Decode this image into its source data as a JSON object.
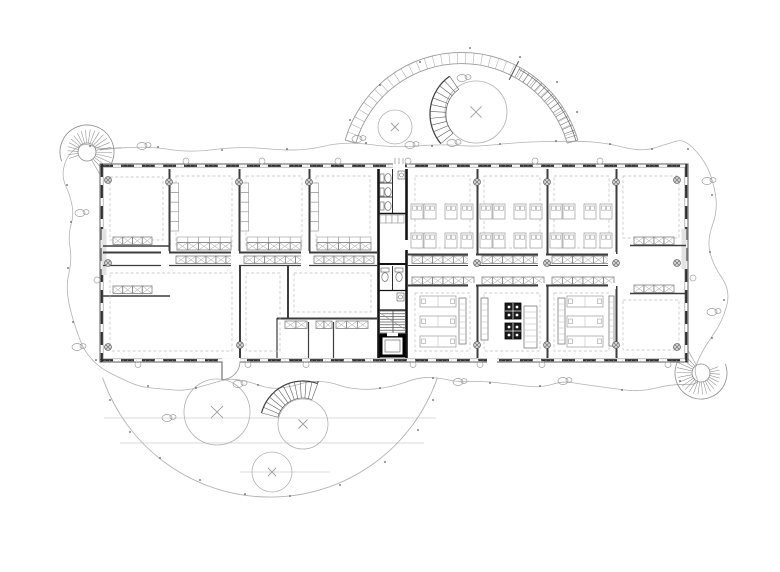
{
  "meta": {
    "drawing_type": "architectural-floor-plan",
    "canvas": {
      "width": 780,
      "height": 572,
      "background": "#ffffff"
    }
  },
  "palette": {
    "wall": "#3d3d3d",
    "core": "#141414",
    "furniture": "#8a8a8a",
    "furniture_light": "#ababab",
    "dashed": "#bfbfbf",
    "site": "#b3b3b3",
    "dark": "#2a2a2a",
    "mid": "#6e6e6e",
    "light_fill": "#e2e2e2",
    "equipment_fill": "#1a1a1a",
    "white": "#ffffff"
  },
  "scene": {
    "cloud_points": [
      [
        100,
        150
      ],
      [
        142,
        145
      ],
      [
        190,
        153
      ],
      [
        240,
        146
      ],
      [
        300,
        152
      ],
      [
        345,
        141
      ],
      [
        395,
        148
      ],
      [
        440,
        144
      ],
      [
        475,
        147
      ],
      [
        520,
        142
      ],
      [
        578,
        141
      ],
      [
        607,
        143
      ],
      [
        642,
        152
      ],
      [
        670,
        143
      ],
      [
        684,
        139
      ],
      [
        703,
        158
      ],
      [
        713,
        180
      ],
      [
        718,
        210
      ],
      [
        707,
        240
      ],
      [
        713,
        265
      ],
      [
        731,
        291
      ],
      [
        722,
        322
      ],
      [
        706,
        345
      ],
      [
        698,
        360
      ],
      [
        694,
        372
      ],
      [
        700,
        385
      ],
      [
        672,
        384
      ],
      [
        640,
        392
      ],
      [
        610,
        388
      ],
      [
        580,
        384
      ],
      [
        563,
        381
      ],
      [
        540,
        388
      ],
      [
        510,
        384
      ],
      [
        480,
        381
      ],
      [
        458,
        382
      ],
      [
        440,
        378
      ],
      [
        420,
        377
      ],
      [
        395,
        386
      ],
      [
        370,
        390
      ],
      [
        347,
        388
      ],
      [
        330,
        382
      ],
      [
        310,
        381
      ],
      [
        290,
        387
      ],
      [
        270,
        389
      ],
      [
        250,
        382
      ],
      [
        230,
        378
      ],
      [
        210,
        384
      ],
      [
        185,
        391
      ],
      [
        163,
        389
      ],
      [
        140,
        387
      ],
      [
        120,
        378
      ],
      [
        100,
        368
      ],
      [
        85,
        352
      ],
      [
        78,
        335
      ],
      [
        70,
        310
      ],
      [
        66,
        285
      ],
      [
        72,
        260
      ],
      [
        68,
        235
      ],
      [
        74,
        215
      ],
      [
        70,
        195
      ],
      [
        62,
        178
      ],
      [
        65,
        160
      ],
      [
        75,
        148
      ],
      [
        87,
        143
      ]
    ],
    "shrubs": [
      [
        142,
        146
      ],
      [
        410,
        145
      ],
      [
        563,
        381
      ],
      [
        458,
        382
      ],
      [
        707,
        181
      ],
      [
        712,
        312
      ],
      [
        80,
        213
      ],
      [
        77,
        347
      ],
      [
        238,
        384
      ],
      [
        167,
        418
      ],
      [
        462,
        78
      ],
      [
        452,
        143
      ],
      [
        357,
        139
      ]
    ],
    "dots": [
      [
        158,
        147
      ],
      [
        222,
        150
      ],
      [
        287,
        149
      ],
      [
        366,
        143
      ],
      [
        432,
        146
      ],
      [
        500,
        144
      ],
      [
        556,
        141
      ],
      [
        610,
        144
      ],
      [
        652,
        149
      ],
      [
        688,
        149
      ],
      [
        712,
        195
      ],
      [
        710,
        252
      ],
      [
        724,
        300
      ],
      [
        712,
        338
      ],
      [
        680,
        381
      ],
      [
        622,
        390
      ],
      [
        540,
        386
      ],
      [
        490,
        383
      ],
      [
        433,
        378
      ],
      [
        380,
        388
      ],
      [
        318,
        382
      ],
      [
        258,
        385
      ],
      [
        196,
        388
      ],
      [
        148,
        386
      ],
      [
        96,
        360
      ],
      [
        73,
        322
      ],
      [
        68,
        268
      ],
      [
        71,
        222
      ],
      [
        67,
        185
      ],
      [
        90,
        146
      ],
      [
        350,
        120
      ],
      [
        380,
        85
      ],
      [
        420,
        62
      ],
      [
        470,
        48
      ],
      [
        520,
        57
      ],
      [
        557,
        82
      ],
      [
        577,
        112
      ],
      [
        110,
        400
      ],
      [
        130,
        432
      ],
      [
        160,
        458
      ],
      [
        200,
        480
      ],
      [
        245,
        494
      ],
      [
        290,
        496
      ],
      [
        340,
        485
      ],
      [
        385,
        462
      ],
      [
        418,
        430
      ],
      [
        433,
        400
      ]
    ],
    "top_arc": {
      "cx": 461.5,
      "cy": 173.4,
      "r_out": 121,
      "r_in": 110,
      "a0": 196,
      "a1": 344,
      "tick_deg": 4,
      "ramp_a0": 299,
      "ramp_a1": 344,
      "section_a": 297
    },
    "bottom_arc": {
      "cx": 270,
      "cy": 320,
      "r": 177,
      "a0": 161,
      "a1": 19
    },
    "terrace_lines": [
      [
        104,
        418,
        436,
        418
      ],
      [
        120,
        443,
        424,
        443
      ],
      [
        240,
        472,
        330,
        472
      ]
    ],
    "trees": [
      [
        395,
        127,
        17
      ],
      [
        476,
        112,
        31
      ],
      [
        217,
        412,
        33
      ],
      [
        303,
        424,
        25
      ],
      [
        272,
        472,
        20
      ]
    ],
    "spirals": [
      {
        "cx": 87,
        "cy": 152,
        "r1": 9,
        "r2": 27,
        "a0": -200,
        "a1": 60,
        "n": 22
      },
      {
        "cx": 701,
        "cy": 373,
        "r1": 9,
        "r2": 26,
        "a0": -20,
        "a1": 240,
        "n": 22
      }
    ],
    "stair_fans": [
      {
        "cx": 476,
        "cy": 114,
        "r1": 30,
        "r2": 46,
        "a0": 140,
        "a1": 235,
        "n": 11
      },
      {
        "cx": 303,
        "cy": 424,
        "r1": 26,
        "r2": 43,
        "a0": 195,
        "a1": 290,
        "n": 12
      }
    ],
    "building": {
      "x": 100,
      "y": 164,
      "w": 588,
      "h": 198
    },
    "piers": [
      [
        101.5,
        229,
        5,
        46
      ],
      [
        681.5,
        229,
        5,
        40
      ]
    ],
    "walls": [
      [
        169.5,
        169,
        169.5,
        252,
        2
      ],
      [
        239.5,
        169,
        239.5,
        252,
        2
      ],
      [
        309.5,
        169,
        309.5,
        252,
        2
      ],
      [
        477.5,
        169,
        477.5,
        254,
        2
      ],
      [
        547.5,
        169,
        547.5,
        254,
        2
      ],
      [
        616.5,
        169,
        616.5,
        254,
        2
      ],
      [
        477.5,
        286,
        477.5,
        358,
        2
      ],
      [
        547.5,
        286,
        547.5,
        358,
        2
      ],
      [
        616.5,
        286,
        616.5,
        358,
        2
      ],
      [
        240,
        266,
        240,
        358,
        2
      ],
      [
        288,
        266,
        288,
        318,
        2
      ],
      [
        277,
        318,
        277,
        358,
        1.2
      ],
      [
        308.5,
        322,
        308.5,
        358,
        1.2
      ],
      [
        333.5,
        322,
        333.5,
        358,
        1.2
      ],
      [
        103,
        252.5,
        377,
        252.5,
        2
      ],
      [
        103,
        265.5,
        377,
        265.5,
        1.2
      ],
      [
        408,
        254.5,
        616,
        254.5,
        2
      ],
      [
        408,
        265.5,
        616,
        265.5,
        1
      ],
      [
        408,
        285.5,
        616,
        285.5,
        2
      ],
      [
        103,
        246,
        170,
        246,
        1.5
      ],
      [
        103,
        296,
        170,
        296,
        1.5
      ],
      [
        630,
        245.5,
        686,
        245.5,
        1.5
      ],
      [
        630,
        293.5,
        686,
        293.5,
        1.5
      ],
      [
        277,
        318.5,
        377,
        318.5,
        2
      ]
    ],
    "core_walls": [
      [
        378.5,
        169,
        378.5,
        358,
        2.6
      ],
      [
        406.5,
        169,
        406.5,
        358,
        2.6
      ],
      [
        379,
        213.5,
        406,
        213.5,
        1.5
      ],
      [
        379,
        264,
        406,
        264,
        2
      ],
      [
        379,
        290.5,
        406,
        290.5,
        1.2
      ],
      [
        379,
        310,
        406,
        310,
        1.2
      ],
      [
        379,
        334.5,
        406,
        334.5,
        2
      ],
      [
        392.5,
        169,
        392.5,
        213,
        0.9
      ],
      [
        392.5,
        266,
        392.5,
        290,
        0.9
      ],
      [
        379,
        183,
        392,
        183,
        0.8
      ],
      [
        379,
        197,
        392,
        197,
        0.8
      ]
    ],
    "dashed_rooms": [
      [
        110,
        177,
        53,
        63
      ],
      [
        176,
        176,
        56,
        70
      ],
      [
        246,
        176,
        56,
        70
      ],
      [
        316,
        176,
        54,
        70
      ],
      [
        415,
        176,
        55,
        72
      ],
      [
        484,
        176,
        56,
        72
      ],
      [
        554,
        176,
        55,
        72
      ],
      [
        623,
        176,
        56,
        62
      ],
      [
        110,
        273,
        122,
        78
      ],
      [
        246,
        273,
        34,
        78
      ],
      [
        294,
        273,
        77,
        39
      ],
      [
        415,
        293,
        55,
        58
      ],
      [
        484,
        293,
        56,
        58
      ],
      [
        554,
        293,
        55,
        58
      ],
      [
        623,
        300,
        56,
        50
      ]
    ],
    "locker_rows": [
      [
        176,
        256,
        60,
        6
      ],
      [
        244,
        256,
        62,
        6
      ],
      [
        314,
        256,
        60,
        6
      ],
      [
        412,
        256,
        62,
        6
      ],
      [
        482,
        256,
        62,
        6
      ],
      [
        552,
        256,
        62,
        6
      ],
      [
        412,
        277,
        62,
        6
      ],
      [
        482,
        277,
        62,
        6
      ],
      [
        552,
        277,
        62,
        6
      ],
      [
        285,
        321,
        22,
        2
      ],
      [
        316,
        321,
        16,
        2
      ],
      [
        336,
        321,
        32,
        3
      ],
      [
        634,
        237,
        40,
        4
      ],
      [
        634,
        285,
        40,
        4
      ],
      [
        113,
        237,
        39,
        4
      ],
      [
        113,
        286,
        39,
        4
      ]
    ],
    "bench_doubles": [
      [
        177,
        237,
        54,
        5
      ],
      [
        247,
        237,
        54,
        5
      ],
      [
        317,
        237,
        54,
        5
      ]
    ],
    "shelf_strips": [
      [
        170.5,
        183,
        8,
        48,
        5
      ],
      [
        240.5,
        183,
        8,
        48,
        5
      ],
      [
        310.5,
        183,
        8,
        48,
        5
      ]
    ],
    "desk_rooms": {
      "lefts": [
        408,
        477,
        547
      ],
      "cols": [
        3,
        16,
        37,
        53
      ],
      "rows": [
        204,
        233
      ],
      "size": [
        12,
        15
      ]
    },
    "tables": {
      "size": [
        36,
        11
      ],
      "items": [
        [
          420,
          296
        ],
        [
          420,
          316
        ],
        [
          420,
          336
        ],
        [
          567,
          296
        ],
        [
          567,
          316
        ],
        [
          567,
          336
        ]
      ]
    },
    "cabinets": [
      [
        459,
        298,
        7,
        46
      ],
      [
        481,
        298,
        7,
        42
      ],
      [
        524,
        306,
        13,
        42
      ],
      [
        558,
        298,
        7,
        46
      ],
      [
        609,
        296,
        5,
        50
      ]
    ],
    "equipment": {
      "size": 16,
      "items": [
        [
          505,
          303
        ],
        [
          505,
          323
        ]
      ]
    },
    "columns": [
      [
        169,
        182
      ],
      [
        239,
        182
      ],
      [
        309,
        182
      ],
      [
        477,
        182
      ],
      [
        547,
        182
      ],
      [
        616,
        182
      ],
      [
        477,
        263
      ],
      [
        547,
        263
      ],
      [
        616,
        263
      ],
      [
        477,
        345
      ],
      [
        547,
        345
      ],
      [
        616,
        345
      ],
      [
        240,
        345
      ],
      [
        108,
        180
      ],
      [
        108,
        263
      ],
      [
        108,
        347
      ],
      [
        677,
        180
      ],
      [
        677,
        263
      ],
      [
        677,
        347
      ]
    ],
    "markers": {
      "top_y": 161,
      "top_x": [
        186,
        262,
        338,
        408,
        535,
        600
      ],
      "bottom_y": 364.5,
      "bottom_x": [
        138,
        248,
        306,
        413,
        480,
        542,
        668
      ],
      "sides": [
        [
          97,
          280
        ],
        [
          693,
          278
        ]
      ]
    },
    "core_fixtures": {
      "toilets_right": [
        [
          380,
          172
        ],
        [
          380,
          186
        ],
        [
          380,
          200
        ]
      ],
      "toilets_down": [
        [
          381,
          268
        ],
        [
          395,
          268
        ]
      ],
      "sinks": [
        [
          398,
          171
        ],
        [
          397,
          293
        ]
      ],
      "shelf_row": [
        380,
        215,
        24,
        8,
        4
      ],
      "stair": {
        "x": 380,
        "y": 311,
        "w": 26,
        "h": 22,
        "steps": 8
      },
      "elevator": {
        "x": 381,
        "y": 336,
        "w": 23,
        "h": 20
      }
    },
    "door_gaps": [
      [
        222,
        358.5,
        18,
        6
      ],
      [
        487,
        358.5,
        10,
        6
      ],
      [
        393,
        161.5,
        12,
        6
      ],
      [
        404,
        240,
        6,
        10
      ],
      [
        468,
        252,
        8,
        15
      ],
      [
        538,
        252,
        8,
        15
      ],
      [
        608,
        252,
        8,
        15
      ],
      [
        468,
        283,
        8,
        6
      ],
      [
        538,
        283,
        8,
        6
      ],
      [
        608,
        283,
        8,
        6
      ],
      [
        161,
        251,
        8,
        16
      ],
      [
        231,
        251,
        8,
        16
      ],
      [
        301,
        251,
        8,
        16
      ]
    ],
    "entry_arc": {
      "path_from": [
        240,
        361.5
      ],
      "path_to": [
        222,
        379.5
      ],
      "r": 18,
      "leaf": [
        222,
        361.5,
        222,
        379.5
      ]
    },
    "entry_steps": [
      [
        395,
        158,
        395,
        164
      ],
      [
        399,
        158,
        399,
        164
      ],
      [
        403,
        158,
        403,
        164
      ]
    ]
  }
}
